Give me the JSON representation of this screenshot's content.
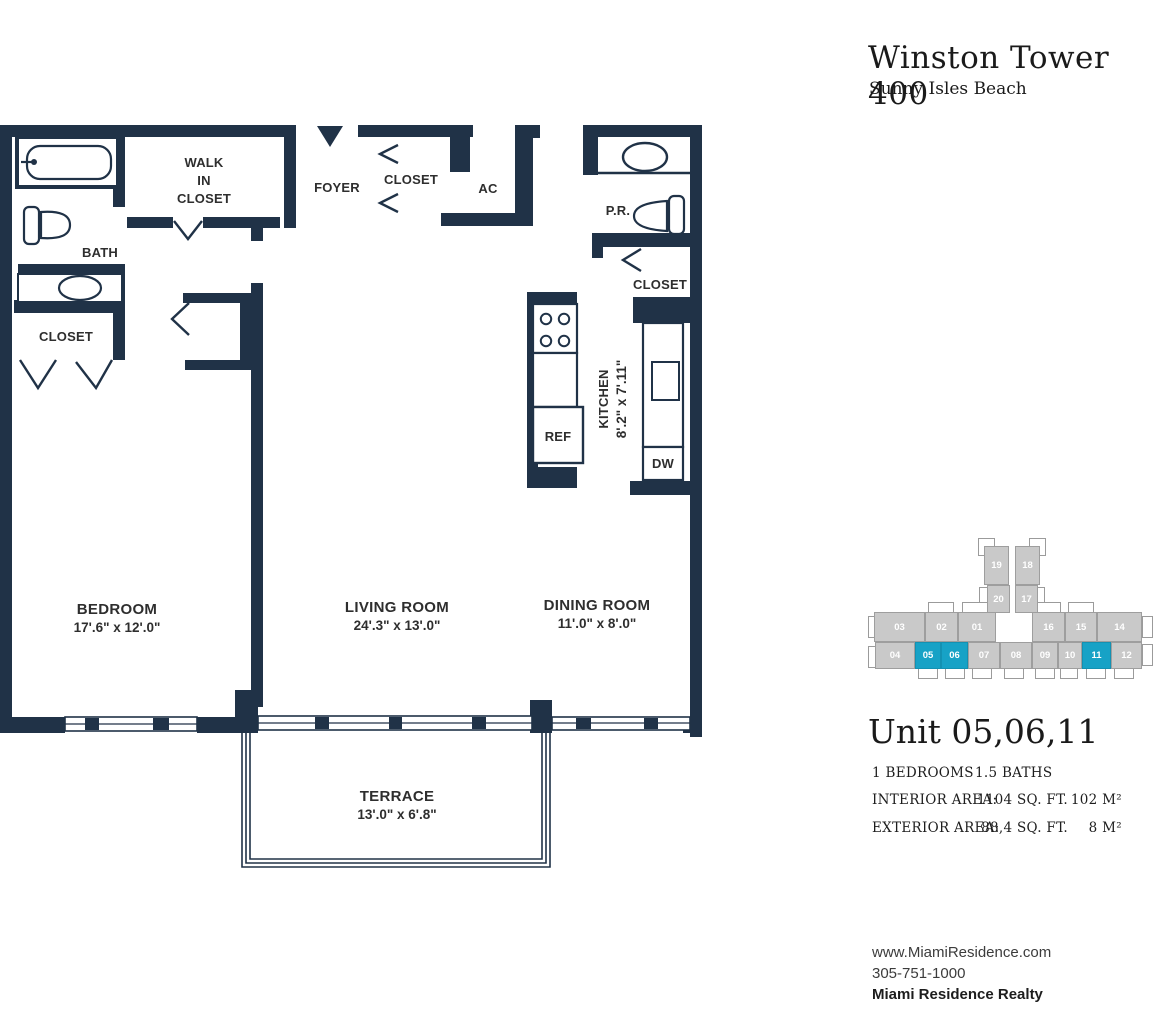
{
  "panel": {
    "building": "Winston Tower 400",
    "location": "Sunny Isles Beach",
    "unit_title": "Unit 05,06,11",
    "bedrooms": "1 BEDROOMS",
    "baths": "1.5 BATHS",
    "interior_label": "INTERIOR AREA:",
    "interior_sqft": "1104 SQ. FT.",
    "interior_m2": "102 M²",
    "exterior_label": "EXTERIOR AREA:",
    "exterior_sqft": "88,4 SQ. FT.",
    "exterior_m2": "8 M²",
    "website": "www.MiamiResidence.com",
    "phone": "305-751-1000",
    "company": "Miami Residence Realty"
  },
  "keyplan": {
    "unit_color": "#c9c9c9",
    "highlight_color": "#17a2c6",
    "highlighted_units": [
      "05",
      "06",
      "11"
    ],
    "outlines": [
      {
        "x": 110,
        "y": 0,
        "w": 17,
        "h": 18
      },
      {
        "x": 161,
        "y": 0,
        "w": 17,
        "h": 18
      },
      {
        "x": 111,
        "y": 49,
        "w": 9,
        "h": 24
      },
      {
        "x": 168,
        "y": 49,
        "w": 9,
        "h": 24
      },
      {
        "x": 60,
        "y": 64,
        "w": 26,
        "h": 12
      },
      {
        "x": 94,
        "y": 64,
        "w": 26,
        "h": 12
      },
      {
        "x": 167,
        "y": 64,
        "w": 26,
        "h": 12
      },
      {
        "x": 200,
        "y": 64,
        "w": 26,
        "h": 12
      },
      {
        "x": 0,
        "y": 78,
        "w": 9,
        "h": 22
      },
      {
        "x": 274,
        "y": 78,
        "w": 11,
        "h": 22
      },
      {
        "x": 0,
        "y": 108,
        "w": 9,
        "h": 22
      },
      {
        "x": 274,
        "y": 106,
        "w": 11,
        "h": 22
      },
      {
        "x": 50,
        "y": 128,
        "w": 20,
        "h": 13
      },
      {
        "x": 77,
        "y": 128,
        "w": 20,
        "h": 13
      },
      {
        "x": 104,
        "y": 128,
        "w": 20,
        "h": 13
      },
      {
        "x": 136,
        "y": 128,
        "w": 20,
        "h": 13
      },
      {
        "x": 167,
        "y": 128,
        "w": 20,
        "h": 13
      },
      {
        "x": 192,
        "y": 128,
        "w": 18,
        "h": 13
      },
      {
        "x": 218,
        "y": 128,
        "w": 20,
        "h": 13
      },
      {
        "x": 246,
        "y": 128,
        "w": 20,
        "h": 13
      }
    ],
    "units": [
      {
        "id": "19",
        "x": 116,
        "y": 8,
        "w": 25,
        "h": 39
      },
      {
        "id": "18",
        "x": 147,
        "y": 8,
        "w": 25,
        "h": 39
      },
      {
        "id": "20",
        "x": 119,
        "y": 47,
        "w": 23,
        "h": 28
      },
      {
        "id": "17",
        "x": 147,
        "y": 47,
        "w": 23,
        "h": 28
      },
      {
        "id": "03",
        "x": 6,
        "y": 74,
        "w": 51,
        "h": 30
      },
      {
        "id": "02",
        "x": 57,
        "y": 74,
        "w": 33,
        "h": 30
      },
      {
        "id": "01",
        "x": 90,
        "y": 74,
        "w": 38,
        "h": 30
      },
      {
        "id": "16",
        "x": 164,
        "y": 74,
        "w": 33,
        "h": 30
      },
      {
        "id": "15",
        "x": 197,
        "y": 74,
        "w": 32,
        "h": 30
      },
      {
        "id": "14",
        "x": 229,
        "y": 74,
        "w": 45,
        "h": 30
      },
      {
        "id": "04",
        "x": 7,
        "y": 104,
        "w": 40,
        "h": 27
      },
      {
        "id": "05",
        "x": 47,
        "y": 104,
        "w": 26,
        "h": 27
      },
      {
        "id": "06",
        "x": 73,
        "y": 104,
        "w": 27,
        "h": 27
      },
      {
        "id": "07",
        "x": 100,
        "y": 104,
        "w": 32,
        "h": 27
      },
      {
        "id": "08",
        "x": 132,
        "y": 104,
        "w": 32,
        "h": 27
      },
      {
        "id": "09",
        "x": 164,
        "y": 104,
        "w": 26,
        "h": 27
      },
      {
        "id": "10",
        "x": 190,
        "y": 104,
        "w": 24,
        "h": 27
      },
      {
        "id": "11",
        "x": 214,
        "y": 104,
        "w": 29,
        "h": 27
      },
      {
        "id": "12",
        "x": 243,
        "y": 104,
        "w": 31,
        "h": 27
      }
    ]
  },
  "floorplan": {
    "wall_color": "#203247",
    "rooms": {
      "bedroom_name": "BEDROOM",
      "bedroom_dims": "17'.6\" x 12'.0\"",
      "living_name": "LIVING ROOM",
      "living_dims": "24'.3\" x 13'.0\"",
      "dining_name": "DINING ROOM",
      "dining_dims": "11'.0\" x 8'.0\"",
      "terrace_name": "TERRACE",
      "terrace_dims": "13'.0\" x 6'.8\"",
      "kitchen_name": "KITCHEN",
      "kitchen_dims": "8'.2\" x 7'.11\""
    },
    "labels": {
      "bath": "BATH",
      "bath_closet": "CLOSET",
      "walkin_1": "WALK",
      "walkin_2": "IN",
      "walkin_3": "CLOSET",
      "foyer": "FOYER",
      "foyer_closet": "CLOSET",
      "ac": "AC",
      "pr": "P.R.",
      "pr_closet": "CLOSET",
      "ref": "REF",
      "dw": "DW"
    }
  }
}
